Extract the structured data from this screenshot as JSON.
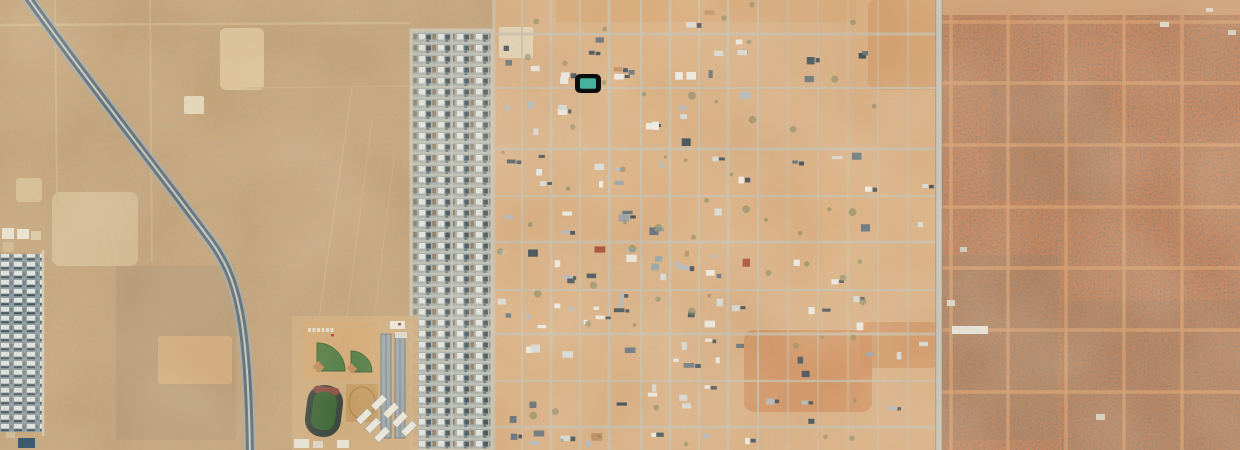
{
  "view": {
    "type": "satellite-aerial-imagery",
    "subject": "Aerial view of a desert town: diagonal divided highway on the left, dense residential subdivision strip, semi-rural gridded lots in the center, school complex with track and ball fields, platted undeveloped desert on the right, and one selected-parcel marker",
    "has_text_labels": false
  },
  "marker": {
    "name": "selected-parcel-marker",
    "x": 575,
    "y": 74,
    "width": 26,
    "height": 19,
    "rx": 5,
    "outline_color": "#0c0d0d",
    "fill_color": "#46b19c",
    "inner": {
      "x": 580,
      "y": 78.2,
      "w": 16,
      "h": 10.6,
      "rx": 1.5
    }
  },
  "zones": [
    {
      "name": "desert-left-region",
      "x": 0,
      "y": 0,
      "w": 494,
      "h": 450,
      "fill": "#c3a379",
      "speckle": "spLeft"
    },
    {
      "name": "town-grid-region",
      "x": 492,
      "y": 0,
      "w": 448,
      "h": 450,
      "fill": "#d9b084",
      "speckle": "spCenter"
    },
    {
      "name": "desert-right-region",
      "x": 938,
      "y": 0,
      "w": 302,
      "h": 450,
      "fill": "#c5825a",
      "speckle": "spRight"
    }
  ],
  "speckles": {
    "spLeft": {
      "bf": 0.42,
      "seed": 11,
      "color": "#6b5a43",
      "gain": 2.5,
      "bias": -1.28,
      "opacity": 0.9
    },
    "spCenter": {
      "bf": 0.4,
      "seed": 5,
      "color": "#7a6449",
      "gain": 2.2,
      "bias": -1.45,
      "opacity": 0.75
    },
    "spRight": {
      "bf": 0.5,
      "seed": 23,
      "color": "#46372b",
      "gain": 2.7,
      "bias": -1.12,
      "opacity": 0.95
    },
    "spStrip": {
      "bf": 0.5,
      "seed": 41,
      "color": "#2f3b44",
      "gain": 2.3,
      "bias": -1.35,
      "opacity": 0.5
    }
  },
  "mottles": [
    {
      "bf": 0.007,
      "seed": 9,
      "color": "#7d5f46",
      "gain": 0.5,
      "bias": -0.1,
      "opacity": 0.45
    },
    {
      "bf": 0.011,
      "seed": 31,
      "color": "#ecd3a8",
      "gain": 0.55,
      "bias": -0.12,
      "opacity": 0.5
    }
  ],
  "patches": [
    {
      "x": 220,
      "y": 28,
      "w": 44,
      "h": 62,
      "fill": "#dfc9a1",
      "o": 0.85,
      "r": 6
    },
    {
      "x": 52,
      "y": 192,
      "w": 86,
      "h": 74,
      "fill": "#d6c09a",
      "o": 0.8,
      "r": 8
    },
    {
      "x": 116,
      "y": 266,
      "w": 120,
      "h": 174,
      "fill": "#b39a77",
      "o": 0.75,
      "r": 4
    },
    {
      "x": 158,
      "y": 336,
      "w": 74,
      "h": 48,
      "fill": "#d3ad7c",
      "o": 0.9,
      "r": 3
    },
    {
      "x": 184,
      "y": 96,
      "w": 20,
      "h": 18,
      "fill": "#e7dbbf",
      "o": 0.9,
      "r": 2
    },
    {
      "x": 16,
      "y": 178,
      "w": 26,
      "h": 24,
      "fill": "#dcc79f",
      "o": 0.7,
      "r": 4
    },
    {
      "x": 499,
      "y": 27,
      "w": 34,
      "h": 31,
      "fill": "#e5d9bd",
      "o": 0.92,
      "r": 2
    },
    {
      "x": 744,
      "y": 330,
      "w": 128,
      "h": 82,
      "fill": "#cd8b59",
      "o": 0.75,
      "r": 10
    },
    {
      "x": 860,
      "y": 322,
      "w": 80,
      "h": 46,
      "fill": "#cd8b59",
      "o": 0.6,
      "r": 10
    },
    {
      "x": 868,
      "y": 0,
      "w": 72,
      "h": 90,
      "fill": "#cd9260",
      "o": 0.5,
      "r": 8
    },
    {
      "x": 940,
      "y": 0,
      "w": 300,
      "h": 15,
      "fill": "#d3a57a",
      "o": 0.8,
      "r": 0
    },
    {
      "x": 556,
      "y": 0,
      "w": 300,
      "h": 22,
      "fill": "#d2995f",
      "o": 0.3,
      "r": 0
    },
    {
      "x": 940,
      "y": 255,
      "w": 118,
      "h": 185,
      "fill": "#8d8068",
      "o": 0.28,
      "r": 0
    },
    {
      "x": 1062,
      "y": 300,
      "w": 178,
      "h": 150,
      "fill": "#8d8068",
      "o": 0.22,
      "r": 0
    },
    {
      "x": 990,
      "y": 80,
      "w": 120,
      "h": 120,
      "fill": "#8d8068",
      "o": 0.18,
      "r": 0
    }
  ],
  "left_tracks": [
    {
      "x1": 0,
      "y1": 25,
      "x2": 410,
      "y2": 23,
      "w": 2.5,
      "c": "#cfb68c",
      "o": 0.9
    },
    {
      "x1": 55,
      "y1": 0,
      "x2": 57,
      "y2": 205,
      "w": 2,
      "c": "#cfb68c",
      "o": 0.8
    },
    {
      "x1": 150,
      "y1": 0,
      "x2": 152,
      "y2": 262,
      "w": 2,
      "c": "#cfb68c",
      "o": 0.7
    },
    {
      "x1": 300,
      "y1": 450,
      "x2": 352,
      "y2": 88,
      "w": 1.6,
      "c": "#cdb187",
      "o": 0.8
    },
    {
      "x1": 330,
      "y1": 450,
      "x2": 372,
      "y2": 120,
      "w": 1.4,
      "c": "#cdb187",
      "o": 0.7
    },
    {
      "x1": 358,
      "y1": 450,
      "x2": 395,
      "y2": 150,
      "w": 1.2,
      "c": "#cdb187",
      "o": 0.6
    },
    {
      "x1": 246,
      "y1": 88,
      "x2": 410,
      "y2": 86,
      "w": 1.6,
      "c": "#cdb187",
      "o": 0.6
    }
  ],
  "center_grid": {
    "color": "#c8c0ac",
    "verticals": [
      494,
      522,
      551,
      580,
      609,
      641,
      670,
      699,
      728,
      758,
      788,
      818,
      848,
      878,
      908,
      936
    ],
    "horizontals": [
      34,
      88,
      149,
      196,
      242,
      290,
      334,
      381,
      427
    ],
    "x1": 492,
    "x2": 938,
    "y1": 0,
    "y2": 450,
    "fade_x": 758
  },
  "right_grid": {
    "color": "#d59d6f",
    "verticals": [
      951,
      1008,
      1066,
      1124,
      1182
    ],
    "horizontals": [
      22,
      83,
      145,
      207,
      268,
      330,
      392
    ],
    "x1": 940,
    "x2": 1240,
    "y1": 15,
    "y2": 450
  },
  "main_road": {
    "x": 939,
    "w": 5.5,
    "fill": "#c9c4b6",
    "edge": "#8c8878"
  },
  "highway": {
    "d": "M 24,-8 C 85,78 152,162 210,240 C 238,278 248,318 250,456",
    "outer": "#a6aba6",
    "outer_w": 12,
    "dark": "#5a6c79",
    "dark_w": 8,
    "median": "#c6cabf",
    "median_w": 2
  },
  "suburb_strip": {
    "x": 411,
    "y": 30,
    "w": 81,
    "h": 420,
    "border_color": "#cbc5b2",
    "road_x": 452,
    "road_color": "#c3c8be"
  },
  "far_left_suburb": {
    "x": 0,
    "y": 254,
    "w": 42,
    "h": 178,
    "border_color": "#cfc9b5",
    "top_squares": [
      {
        "x": 2,
        "y": 228,
        "w": 12,
        "h": 11,
        "f": "#e9e4d4"
      },
      {
        "x": 17,
        "y": 229,
        "w": 12,
        "h": 10,
        "f": "#e9e4d4"
      },
      {
        "x": 31,
        "y": 231,
        "w": 10,
        "h": 9,
        "f": "#d9c9a6"
      },
      {
        "x": 3,
        "y": 242,
        "w": 11,
        "h": 10,
        "f": "#cdb78f"
      }
    ]
  },
  "school": {
    "ground": {
      "x": 292,
      "y": 316,
      "w": 126,
      "h": 134,
      "fill": "#cfae80"
    },
    "pad": {
      "x": 303,
      "y": 322,
      "w": 76,
      "h": 58,
      "fill": "#d4aa77"
    },
    "fan_large": "M317,371 L317,343 A28,28 0 0 1 345,371 Z",
    "fan_small": "M351,372 L351,351 A21,21 0 0 1 372,372 Z",
    "green": "#4c7a41",
    "green_dark": "#3c622f",
    "infield1": {
      "x": 314,
      "y": 363,
      "w": 9,
      "h": 8,
      "fill": "#c08b58"
    },
    "infield2": {
      "x": 348,
      "y": 365,
      "w": 8,
      "h": 7,
      "fill": "#c08b58"
    },
    "bleachers": {
      "x0": 308,
      "y": 328,
      "n": 6,
      "step": 4.5,
      "w": 3,
      "h": 4,
      "f": "#e8e2d2"
    },
    "track": {
      "x": 306,
      "y": 385,
      "w": 36,
      "h": 52,
      "rx": 17,
      "rot": 7,
      "cx": 324,
      "cy": 411,
      "outer": "#3a463e",
      "red": "#8a5046",
      "inner": "#41683a"
    },
    "tan_field": {
      "x": 346,
      "y": 384,
      "w": 32,
      "h": 38,
      "fill": "#c49c64",
      "oval": "#ac8751"
    },
    "bars": [
      {
        "x": 356,
        "y": 413
      },
      {
        "x": 365,
        "y": 422
      },
      {
        "x": 374,
        "y": 431
      },
      {
        "x": 383,
        "y": 407
      },
      {
        "x": 392,
        "y": 416
      },
      {
        "x": 401,
        "y": 425
      },
      {
        "x": 371,
        "y": 399
      }
    ],
    "bar_w": 16,
    "bar_h": 7,
    "bar_rot": -45,
    "bar_fill": "#eceade",
    "south_buildings": [
      {
        "x": 294,
        "y": 439,
        "w": 15,
        "h": 9,
        "f": "#e7e3d6"
      },
      {
        "x": 313,
        "y": 441,
        "w": 10,
        "h": 7,
        "f": "#dcd6c5"
      },
      {
        "x": 337,
        "y": 440,
        "w": 12,
        "h": 8,
        "f": "#e7e3d6"
      }
    ],
    "north_buildings": [
      {
        "x": 390,
        "y": 321,
        "w": 15,
        "h": 8,
        "f": "#ece9dd"
      },
      {
        "x": 395,
        "y": 332,
        "w": 12,
        "h": 6,
        "f": "#e0dccd"
      }
    ],
    "red_dots": [
      {
        "x": 398,
        "y": 323
      },
      {
        "x": 331,
        "y": 334
      }
    ],
    "red_dot_color": "#a63c2c",
    "strips": [
      {
        "x": 381,
        "y": 334,
        "w": 10,
        "h": 104
      },
      {
        "x": 395,
        "y": 334,
        "w": 10,
        "h": 104
      }
    ],
    "strip_fill": "#9aa7ad",
    "strip_edge": "#5f6d75"
  },
  "houses": {
    "seed": 1337,
    "palette": [
      "#eeece4",
      "#d8dcd9",
      "#b3babf",
      "#64727c",
      "#404e58",
      "#97a1a8",
      "#bc8d60",
      "#a44b33"
    ],
    "weights": [
      3,
      2,
      2,
      2,
      2,
      1,
      0.7,
      0.4
    ],
    "shrub": "#76825f"
  },
  "right_structures": [
    {
      "x": 952,
      "y": 326,
      "w": 36,
      "h": 8,
      "f": "#e9e6dd"
    },
    {
      "x": 947,
      "y": 300,
      "w": 8,
      "h": 6,
      "f": "#dcd8cc"
    },
    {
      "x": 960,
      "y": 247,
      "w": 7,
      "h": 5,
      "f": "#cfc9ba"
    },
    {
      "x": 1160,
      "y": 22,
      "w": 9,
      "h": 5,
      "f": "#e2ddd0"
    },
    {
      "x": 1206,
      "y": 8,
      "w": 7,
      "h": 4,
      "f": "#e2ddd0"
    },
    {
      "x": 1228,
      "y": 30,
      "w": 8,
      "h": 5,
      "f": "#d8d2c2"
    },
    {
      "x": 1096,
      "y": 414,
      "w": 9,
      "h": 6,
      "f": "#d8d2c2"
    }
  ],
  "left_structures": [
    {
      "x": 18,
      "y": 438,
      "w": 17,
      "h": 10,
      "f": "#274864"
    },
    {
      "x": 6,
      "y": 432,
      "w": 9,
      "h": 6,
      "f": "#cabb96"
    }
  ],
  "suburb_patterns": {
    "housesA": {
      "tw": 13,
      "th": 9,
      "rects": [
        {
          "x": 0,
          "y": 0,
          "w": 13,
          "h": 9,
          "f": "#8c9ba1"
        },
        {
          "x": 1,
          "y": 1,
          "w": 8,
          "h": 4.5,
          "f": "#e2e6e2"
        },
        {
          "x": 1,
          "y": 6.2,
          "w": 8,
          "h": 2,
          "f": "#3e4d58"
        },
        {
          "x": 10,
          "y": 1.8,
          "w": 2.4,
          "h": 4.5,
          "f": "#707f89"
        }
      ]
    },
    "housesB": {
      "tw": 19,
      "th": 11,
      "rects": [
        {
          "x": 0,
          "y": 0,
          "w": 19,
          "h": 11,
          "f": "#a8b1ac"
        },
        {
          "x": 0,
          "y": 8.6,
          "w": 19,
          "h": 2.4,
          "f": "#bdc1b7"
        },
        {
          "x": 1,
          "y": 1,
          "w": 6,
          "h": 5.5,
          "f": "#e6e9e4"
        },
        {
          "x": 8.3,
          "y": 1.6,
          "w": 4.6,
          "h": 5,
          "f": "#41515b"
        },
        {
          "x": 14.3,
          "y": 1,
          "w": 3.6,
          "h": 5.4,
          "f": "#8f7d67"
        },
        {
          "x": 8.3,
          "y": 7.2,
          "w": 3,
          "h": 1.6,
          "f": "#5a6871"
        }
      ]
    }
  }
}
